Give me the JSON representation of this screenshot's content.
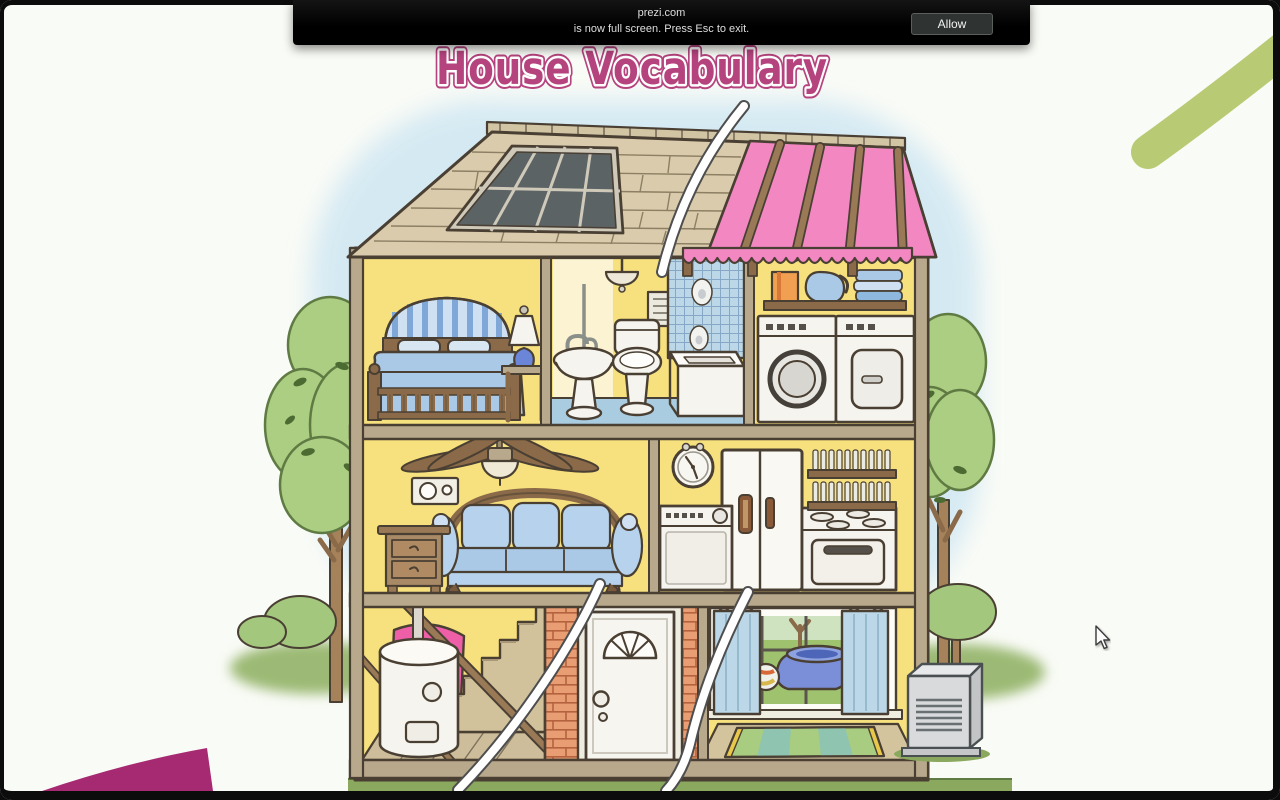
{
  "page": {
    "title_text": "House Vocabulary"
  },
  "notification_bar": {
    "site": "prezi.com",
    "message": "is now full screen. Press Esc to exit.",
    "allow_label": "Allow"
  },
  "palette": {
    "page_bg": "#f9fbf6",
    "frame": "#0b0c0b",
    "bar_bg": "#141414",
    "bar_text": "#dedede",
    "allow_bg": "#2f3433",
    "allow_border": "#5a5f5c",
    "allow_text": "#f2f2f2",
    "title": "#b5437e",
    "title_halo": "#ffffff",
    "outline": "#4a3f33",
    "sky": "#d2e8f3",
    "grass": "#9cba74",
    "grass_line": "#5f7a43",
    "foliage": "#abce82",
    "foliage_line": "#5f7a43",
    "trunk": "#a5825a",
    "wall_yellow": "#f6e17e",
    "wall_pale": "#fbf3d2",
    "wood": "#8a6a48",
    "wood_light": "#b9a98c",
    "roof": "#d9cbab",
    "roof_cap": "#d2c5a4",
    "shingle_line": "#8d7f63",
    "skylight_glass": "#5c6365",
    "skylight_frame": "#cfc9ba",
    "insulation": "#f287c2",
    "pink_accent": "#ee5fa8",
    "blue_item": "#a9c9e6",
    "blue_light": "#cfe0f2",
    "tile": "#bcd8e8",
    "floor_blue": "#a9cce0",
    "appliance": "#f6f4ee",
    "appliance_dark": "#55504a",
    "brick": "#e89d72",
    "brick_line": "#b4633e",
    "curtain": "#bcd8e8",
    "backyard_green": "#9fc26e",
    "rug_green": "#a8cc80",
    "rug_teal": "#8fc4b0",
    "rug_fringe": "#e8c84c",
    "pool": "#7b8fd8",
    "pool_rim": "#4d66b8",
    "ac": "#d8dadc",
    "ac_line": "#6a6f72",
    "stair_wood": "#d2c29c",
    "plank": "#cdbd9a",
    "corner_pink": "#a62a72",
    "corner_green": "#b9ca74"
  },
  "illustration": {
    "name": "house-vocabulary-cutaway",
    "rooms": [
      {
        "name": "attic-roof",
        "items": [
          "shingles",
          "skylight",
          "pink-insulation",
          "rafters",
          "awning-valance"
        ]
      },
      {
        "name": "bedroom",
        "items": [
          "bed",
          "striped-headboard",
          "pillows",
          "blanket",
          "nightstand",
          "lamp"
        ]
      },
      {
        "name": "bathroom",
        "items": [
          "pendant-light",
          "towel-ring",
          "vent-panel",
          "pedestal-sink",
          "toilet",
          "tiled-shower",
          "bathtub"
        ]
      },
      {
        "name": "laundry-room",
        "items": [
          "shelf",
          "detergent-box",
          "pitcher",
          "folded-towels",
          "washer",
          "dryer"
        ]
      },
      {
        "name": "living-room",
        "items": [
          "ceiling-fan",
          "thermostat",
          "sofa",
          "end-table"
        ]
      },
      {
        "name": "kitchen",
        "items": [
          "wall-clock",
          "refrigerator",
          "dishwasher",
          "stove",
          "dish-shelves"
        ]
      },
      {
        "name": "basement",
        "items": [
          "water-heater",
          "pink-insulation-roll",
          "staircase",
          "plank-floor"
        ]
      },
      {
        "name": "entry",
        "items": [
          "brick-wall",
          "front-door",
          "fanlight-window",
          "doorknob",
          "deadbolt"
        ]
      },
      {
        "name": "playroom",
        "items": [
          "window",
          "curtains",
          "kiddie-pool",
          "beach-ball",
          "striped-rug"
        ]
      },
      {
        "name": "exterior",
        "items": [
          "trees",
          "bushes",
          "lawn",
          "air-conditioner"
        ]
      }
    ]
  }
}
